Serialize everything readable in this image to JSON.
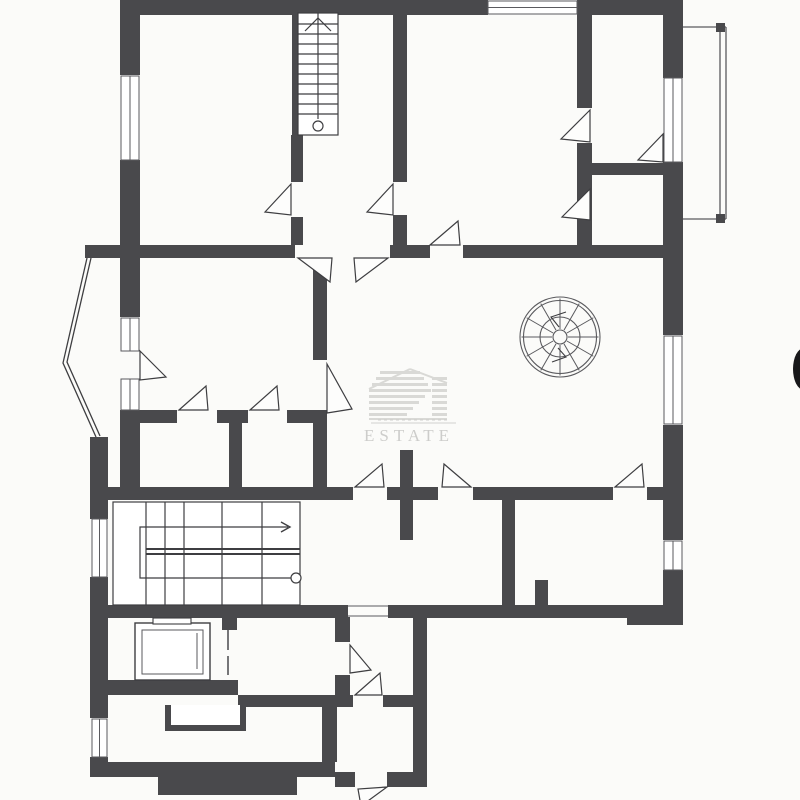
{
  "watermark": {
    "brand": "ESTATE",
    "bar_color": "#d9d9d6",
    "rule_color": "#d2d2cf",
    "text_color": "#cdcdcb",
    "bars": [
      [
        380,
        371,
        40,
        3
      ],
      [
        376,
        377,
        48,
        3
      ],
      [
        372,
        383,
        56,
        3
      ],
      [
        369,
        389,
        62,
        3
      ],
      [
        369,
        395,
        56,
        3
      ],
      [
        369,
        401,
        50,
        3
      ],
      [
        369,
        407,
        44,
        3
      ],
      [
        369,
        413,
        38,
        3
      ],
      [
        432,
        377,
        15,
        3
      ],
      [
        432,
        383,
        15,
        3
      ],
      [
        432,
        389,
        15,
        3
      ],
      [
        432,
        395,
        15,
        3
      ],
      [
        432,
        401,
        15,
        3
      ],
      [
        432,
        407,
        15,
        3
      ],
      [
        432,
        413,
        15,
        3
      ],
      [
        369,
        418,
        78,
        2
      ]
    ],
    "roof_lines": [
      [
        369,
        389,
        410,
        369
      ],
      [
        410,
        369,
        447,
        383
      ]
    ],
    "rule": [
      371,
      423,
      456,
      423
    ],
    "tagline_marks": {
      "x0": 378,
      "y": 419,
      "count": 12,
      "step": 6,
      "w": 3,
      "h": 1.5
    },
    "text_pos": [
      409,
      441
    ]
  },
  "plan": {
    "bg": "#fbfbf9",
    "wall_color": "#49494c",
    "stroke": "#3e3e41",
    "thin": "#5a5a5e",
    "walls": [
      [
        120,
        0,
        368,
        15
      ],
      [
        577,
        0,
        106,
        15
      ],
      [
        120,
        15,
        20,
        60
      ],
      [
        120,
        160,
        20,
        90
      ],
      [
        663,
        15,
        20,
        63
      ],
      [
        663,
        162,
        20,
        96
      ],
      [
        292,
        13,
        6,
        122
      ],
      [
        291,
        135,
        12,
        47
      ],
      [
        291,
        217,
        12,
        28
      ],
      [
        393,
        15,
        14,
        167
      ],
      [
        393,
        215,
        14,
        30
      ],
      [
        577,
        15,
        15,
        93
      ],
      [
        577,
        143,
        15,
        115
      ],
      [
        592,
        163,
        71,
        12
      ],
      [
        85,
        245,
        210,
        13
      ],
      [
        390,
        245,
        40,
        13
      ],
      [
        463,
        245,
        220,
        13
      ],
      [
        120,
        250,
        20,
        67
      ],
      [
        120,
        410,
        20,
        77
      ],
      [
        663,
        258,
        20,
        77
      ],
      [
        663,
        425,
        20,
        73
      ],
      [
        313,
        258,
        14,
        102
      ],
      [
        313,
        415,
        14,
        83
      ],
      [
        120,
        410,
        57,
        13
      ],
      [
        217,
        410,
        31,
        13
      ],
      [
        287,
        410,
        40,
        13
      ],
      [
        229,
        423,
        13,
        75
      ],
      [
        400,
        450,
        13,
        37
      ],
      [
        400,
        500,
        13,
        40
      ],
      [
        90,
        437,
        18,
        82
      ],
      [
        90,
        577,
        18,
        141
      ],
      [
        90,
        757,
        18,
        20
      ],
      [
        93,
        487,
        260,
        13
      ],
      [
        387,
        487,
        51,
        13
      ],
      [
        473,
        487,
        140,
        13
      ],
      [
        647,
        487,
        36,
        13
      ],
      [
        663,
        498,
        20,
        42
      ],
      [
        663,
        570,
        20,
        55
      ],
      [
        502,
        500,
        13,
        107
      ],
      [
        535,
        580,
        13,
        27
      ],
      [
        108,
        605,
        240,
        13
      ],
      [
        388,
        605,
        275,
        13
      ],
      [
        627,
        605,
        56,
        20
      ],
      [
        222,
        617,
        15,
        13
      ],
      [
        108,
        680,
        130,
        15
      ],
      [
        335,
        617,
        15,
        25
      ],
      [
        335,
        675,
        15,
        20
      ],
      [
        238,
        695,
        115,
        12
      ],
      [
        383,
        695,
        44,
        12
      ],
      [
        413,
        617,
        14,
        170
      ],
      [
        322,
        707,
        15,
        55
      ],
      [
        90,
        762,
        245,
        15
      ],
      [
        335,
        772,
        20,
        15
      ],
      [
        387,
        772,
        26,
        15
      ],
      [
        158,
        777,
        139,
        18
      ]
    ],
    "windows": [
      {
        "r": [
          488,
          1,
          89,
          13
        ],
        "o": "h"
      },
      {
        "r": [
          121,
          76,
          18,
          84
        ],
        "o": "v"
      },
      {
        "r": [
          664,
          78,
          18,
          84
        ],
        "o": "v"
      },
      {
        "r": [
          664,
          336,
          18,
          88
        ],
        "o": "v"
      },
      {
        "r": [
          664,
          541,
          18,
          29
        ],
        "o": "v"
      },
      {
        "r": [
          121,
          318,
          18,
          33
        ],
        "o": "v"
      },
      {
        "r": [
          121,
          379,
          18,
          31
        ],
        "o": "v"
      },
      {
        "r": [
          92,
          519,
          15,
          58
        ],
        "o": "v"
      },
      {
        "r": [
          92,
          719,
          15,
          38
        ],
        "o": "v"
      }
    ],
    "doors": [
      "M291,184 L265,212 L291,215 Z",
      "M393,184 L367,212 L393,215 Z",
      "M590,110 L561,139 L590,142 Z",
      "M590,189 L562,217 L590,220 Z",
      "M663,134 L638,160 L663,162 Z",
      "M298,258 L330,282 L332,258 Z",
      "M388,258 L356,282 L354,258 Z",
      "M430,245 L458,221 L460,245 Z",
      "M327,364 L352,409 L327,413 Z",
      "M140,351 L166,377 L140,380 Z",
      "M179,410 L206,386 L208,410 Z",
      "M250,410 L277,386 L279,410 Z",
      "M355,487 L382,464 L384,487 Z",
      "M471,487 L444,464 L442,487 Z",
      "M615,487 L642,464 L644,487 Z",
      "M350,645 L371,670 L350,673 Z",
      "M355,695 L380,673 L382,695 Z",
      "M387,787 L361,806 L358,789 Z"
    ],
    "door_lines": [
      [
        228,
        630,
        228,
        650
      ],
      [
        228,
        656,
        228,
        675
      ]
    ],
    "gap_jambs": [
      [
        348,
        606,
        388,
        606
      ],
      [
        348,
        616,
        388,
        616
      ]
    ],
    "bay_polylines": [
      [
        87,
        258,
        63,
        363,
        96,
        437
      ],
      [
        91,
        258,
        67,
        362,
        100,
        436
      ]
    ],
    "balcony": {
      "lines": [
        [
          683,
          27,
          726,
          27
        ],
        [
          683,
          219,
          726,
          219
        ],
        [
          720,
          27,
          720,
          219
        ],
        [
          726,
          27,
          726,
          219
        ]
      ],
      "squares": [
        [
          716,
          23,
          9,
          9
        ],
        [
          716,
          214,
          9,
          9
        ]
      ]
    },
    "stair_top": {
      "frame": [
        298,
        13,
        40,
        122
      ],
      "tread_ys": [
        24,
        34,
        44,
        54,
        64,
        74,
        84,
        94,
        104,
        114
      ],
      "center": [
        318,
        13,
        318,
        119
      ],
      "circle": [
        318,
        126,
        5
      ],
      "chevron": "M305,31 L318,18 L331,31"
    },
    "stair_main": {
      "frame": [
        113,
        502,
        187,
        103
      ],
      "vertical_xs": [
        146,
        165,
        184,
        222,
        262
      ],
      "mid_lines": [
        [
          146,
          549,
          300,
          549
        ],
        [
          146,
          554,
          300,
          554
        ]
      ],
      "arrow_path": "M296,578 L140,578 L140,527 L288,527",
      "arrow_head": "M281,522 L290,527 L281,532",
      "circle": [
        296,
        578,
        5
      ]
    },
    "spiral": {
      "cx": 560,
      "cy": 337,
      "radii": [
        40,
        36.5,
        20,
        7
      ],
      "spokes": 12,
      "arrows": [
        "M566,312 L551,317 L559,327",
        "M552,362 L566,357 L558,348"
      ]
    },
    "fireplace": {
      "outer": [
        135,
        623,
        75,
        57
      ],
      "inner": [
        142,
        630,
        61,
        44
      ],
      "tab": [
        153,
        618,
        38,
        6
      ],
      "detail": [
        197,
        633,
        197,
        669
      ]
    },
    "niche_path": "M168,705 L168,728 L243,728 L243,705",
    "crescent": {
      "cx": 804,
      "cy": 369,
      "rx": 11,
      "ry": 21
    }
  }
}
